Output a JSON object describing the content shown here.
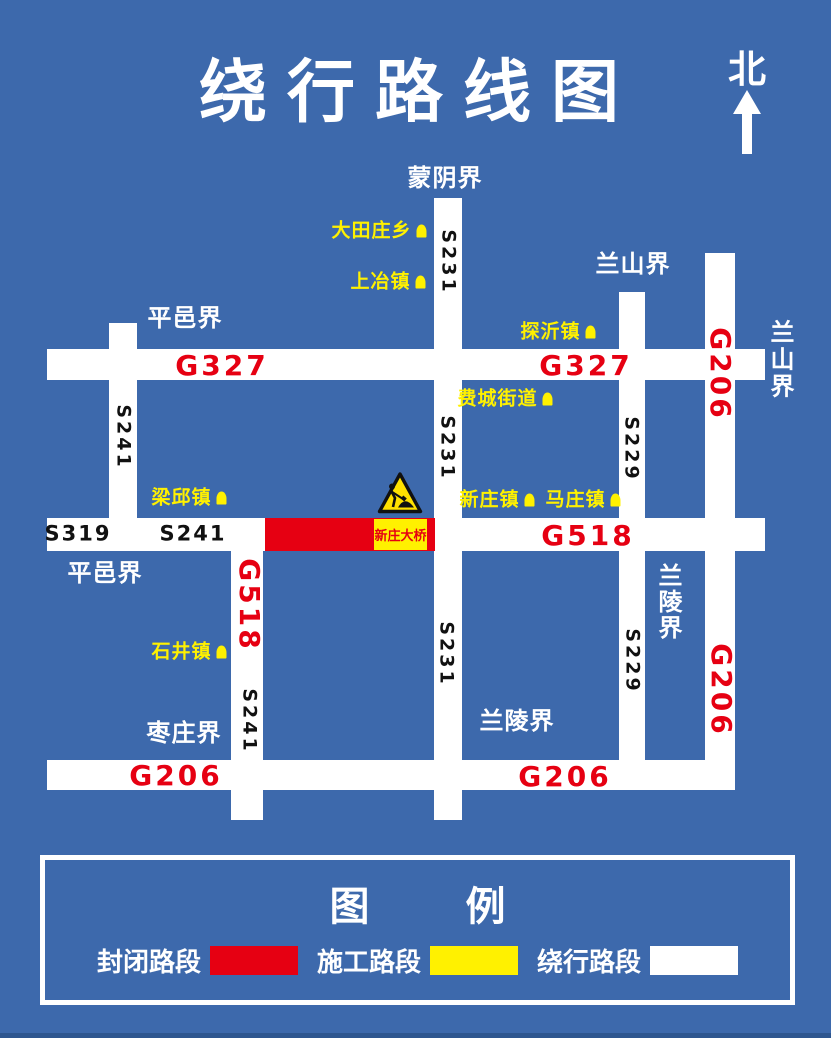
{
  "title": "绕行路线图",
  "north_label": "北",
  "colors": {
    "background": "#3D69AC",
    "road": "#FFFFFF",
    "closed_section": "#E60012",
    "construction": "#FFF100",
    "route_number": "#E60012",
    "road_number": "#111111",
    "boundary_text": "#FFFFFF",
    "town_text": "#FFF100"
  },
  "map": {
    "boundaries": {
      "mengyin": "蒙阴界",
      "pingyi_top": "平邑界",
      "pingyi_left": "平邑界",
      "lanshan_top": "兰山界",
      "lanshan_right": "兰山界",
      "lanling_right": "兰陵界",
      "lanling_bottom": "兰陵界",
      "zaozhuang": "枣庄界"
    },
    "routes": {
      "g327_left": "G327",
      "g327_right": "G327",
      "g518_right": "G518",
      "g518_detour": "G518",
      "g206_bottom_left": "G206",
      "g206_bottom_right": "G206",
      "g206_right_upper": "G206",
      "g206_right_lower": "G206"
    },
    "roads": {
      "s231_upper": "S231",
      "s231_middle": "S231",
      "s231_lower": "S231",
      "s241_left": "S241",
      "s241_mid": "S241",
      "s241_detour": "S241",
      "s319": "S319",
      "s229_upper": "S229",
      "s229_lower": "S229"
    },
    "towns": {
      "datianzhuangxiang": "大田庄乡",
      "shangyezhen": "上冶镇",
      "tanyizhen": "探沂镇",
      "feichengjiedao": "费城街道",
      "liangqiuzhen": "梁邱镇",
      "xinzhuangzhen": "新庄镇",
      "mazhuangzhen": "马庄镇",
      "shijingzhen": "石井镇"
    },
    "closed_section": "新庄大桥"
  },
  "legend": {
    "title_left": "图",
    "title_right": "例",
    "items": [
      {
        "label": "封闭路段",
        "color": "#E60012"
      },
      {
        "label": "施工路段",
        "color": "#FFF100"
      },
      {
        "label": "绕行路段",
        "color": "#FFFFFF"
      }
    ]
  }
}
